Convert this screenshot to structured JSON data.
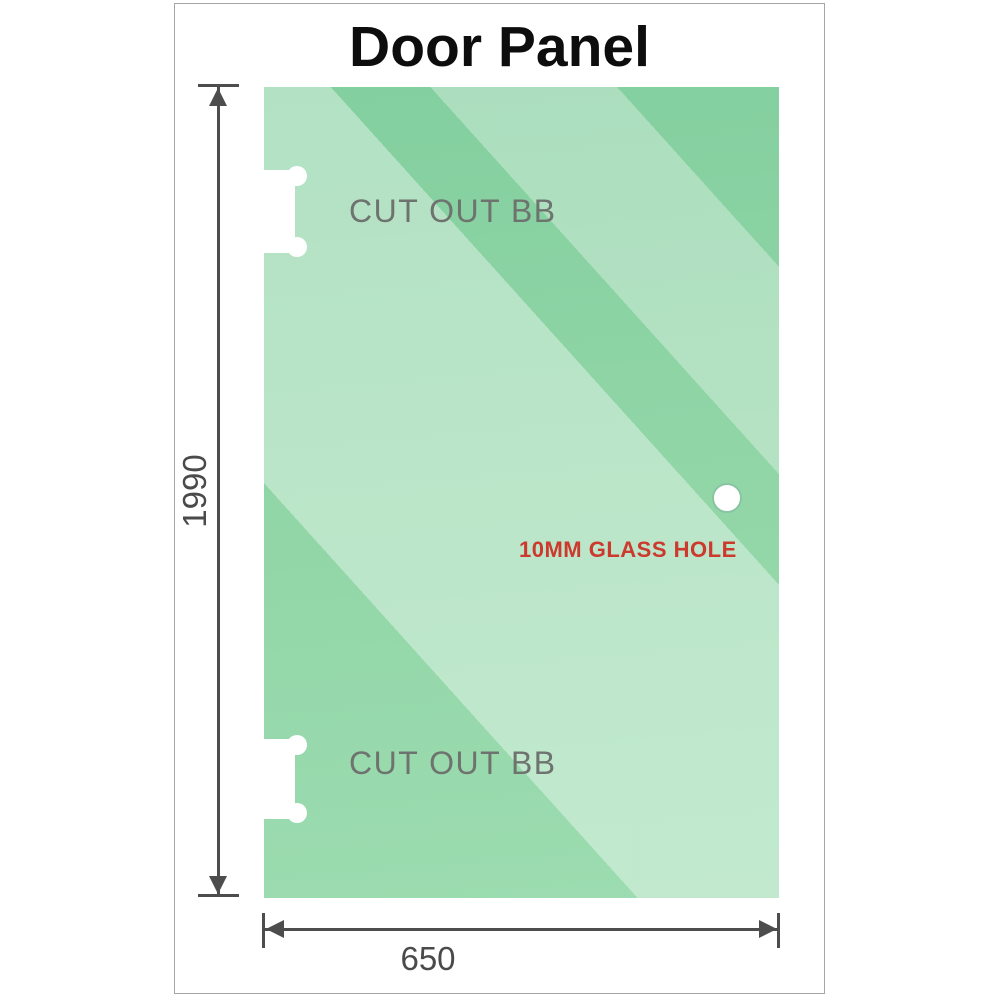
{
  "title": "Door Panel",
  "glass_panel": {
    "cutouts": [
      {
        "label": "CUT OUT BB",
        "position": "top-left"
      },
      {
        "label": "CUT OUT BB",
        "position": "bottom-left"
      }
    ],
    "glass_hole": {
      "label": "10MM GLASS HOLE"
    }
  },
  "dimensions": {
    "height": "1990",
    "width": "650"
  },
  "colors": {
    "glass_green_top": "#83cf9f",
    "glass_green_bottom": "#9cdcb0",
    "glass_sheen": "rgba(255,255,255,0.38)",
    "dimension_lines": "#4d4d4d",
    "dimension_text": "#4a4a4a",
    "cutout_text": "#6f736f",
    "glass_hole_text": "#cc392d",
    "title_text": "#0d0d0d",
    "frame_border": "#a5a5a5"
  }
}
